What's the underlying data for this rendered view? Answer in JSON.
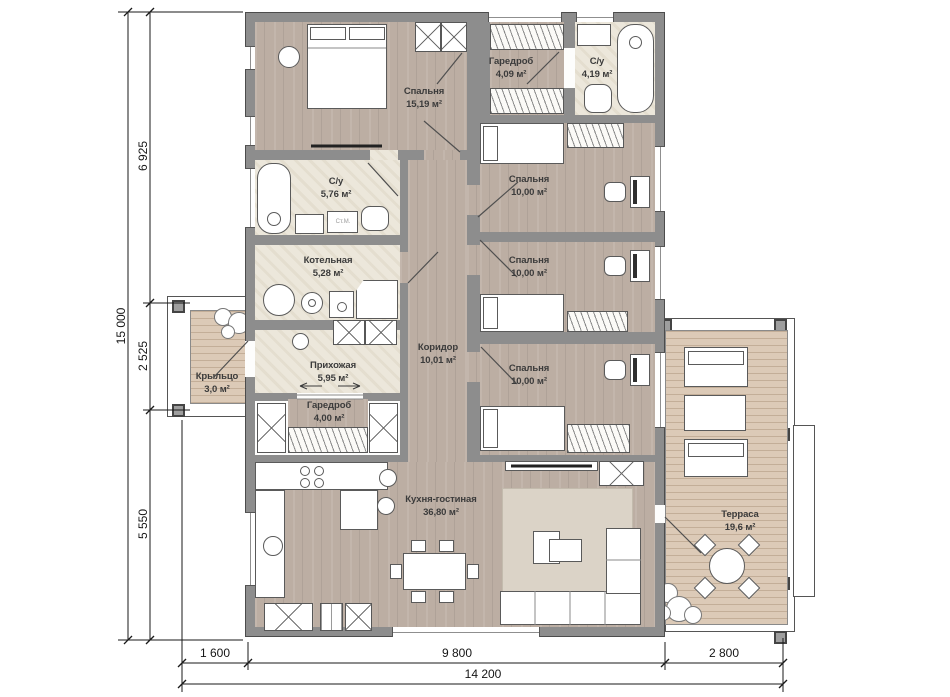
{
  "rooms": [
    {
      "name": "Спальня",
      "area": "15,19 м²"
    },
    {
      "name": "Гаредроб",
      "area": "4,09 м²"
    },
    {
      "name": "С/у",
      "area": "4,19 м²"
    },
    {
      "name": "Спальня",
      "area": "10,00 м²"
    },
    {
      "name": "Спальня",
      "area": "10,00 м²"
    },
    {
      "name": "Спальня",
      "area": "10,00 м²"
    },
    {
      "name": "С/у",
      "area": "5,76 м²"
    },
    {
      "name": "Котельная",
      "area": "5,28 м²"
    },
    {
      "name": "Прихожая",
      "area": "5,95 м²"
    },
    {
      "name": "Коридор",
      "area": "10,01 м²"
    },
    {
      "name": "Гаредроб",
      "area": "4,00 м²"
    },
    {
      "name": "Крыльцо",
      "area": "3,0 м²"
    },
    {
      "name": "Кухня-гостиная",
      "area": "36,80 м²"
    },
    {
      "name": "Терраса",
      "area": "19,6 м²"
    }
  ],
  "dims": {
    "left": {
      "total": "15 000",
      "segments": [
        "6 925",
        "2 525",
        "5 550"
      ]
    },
    "bottom": {
      "total": "14 200",
      "segments": [
        "1 600",
        "9 800",
        "2 800"
      ]
    }
  },
  "appliances": {
    "washing_machine": "Ст.М."
  },
  "colors": {
    "wall": "#8d8d8d",
    "wood_floor": "#bcaea3",
    "tile_floor": "#ece7db",
    "deck": "#dccab7"
  }
}
